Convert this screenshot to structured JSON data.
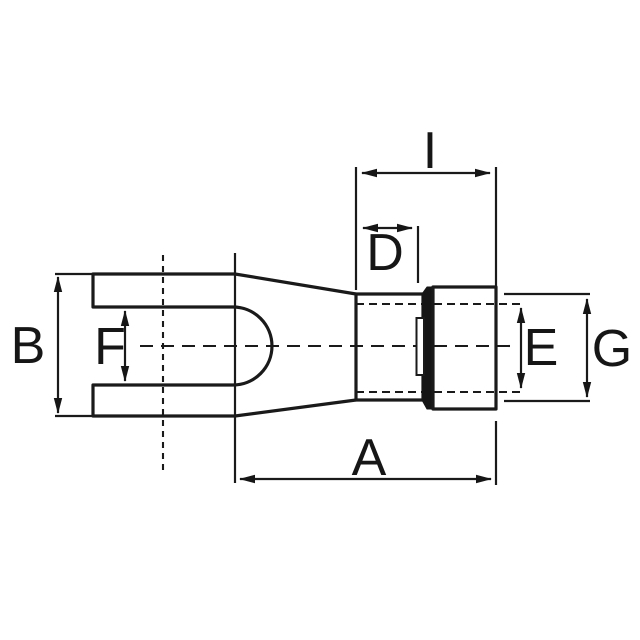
{
  "drawing": {
    "background_color": "#ffffff",
    "line_color": "#1a1a1a",
    "labels": {
      "a": "A",
      "b": "B",
      "d": "D",
      "e": "E",
      "f": "F",
      "g": "G",
      "i": "I"
    }
  }
}
